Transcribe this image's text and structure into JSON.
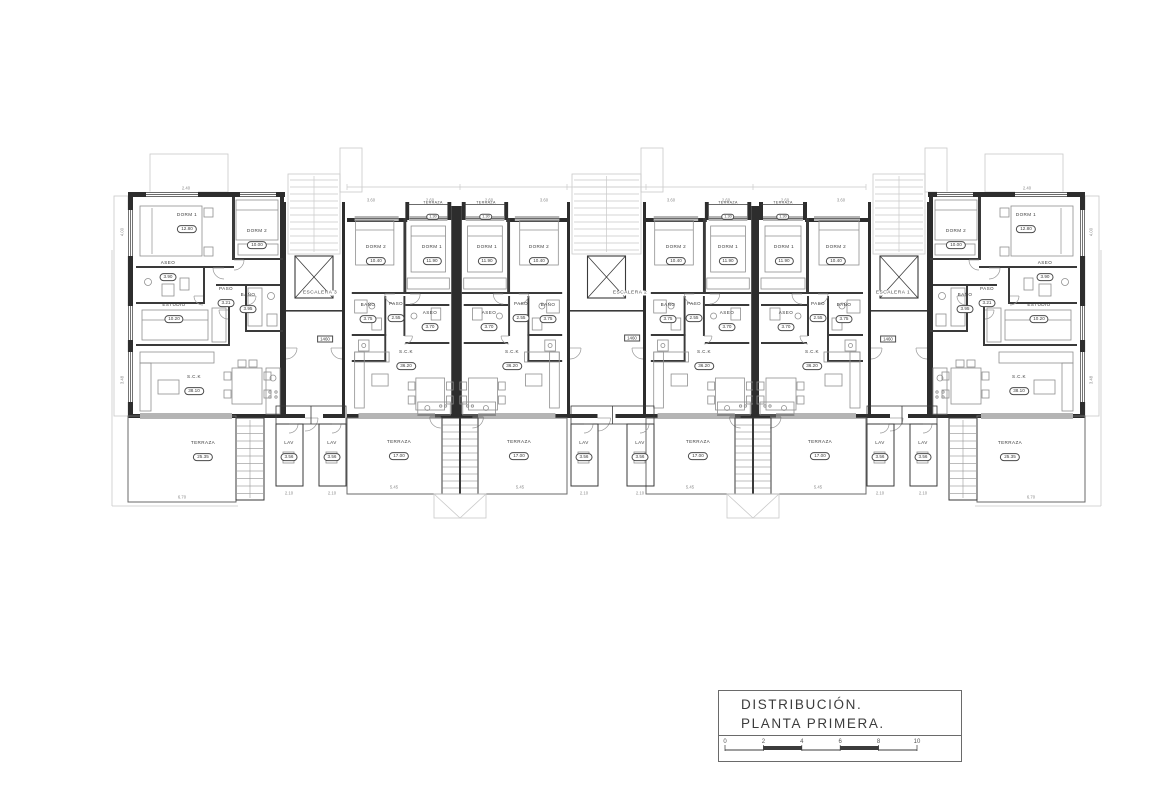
{
  "title_block": {
    "line1": "DISTRIBUCIÓN.",
    "line2": "PLANTA  PRIMERA.",
    "scale_ticks": [
      "0",
      "2",
      "4",
      "6",
      "8",
      "10"
    ]
  },
  "colors": {
    "line": "#3a3a3a",
    "wall": "#2d2d2d",
    "light": "#c9c9c9",
    "furn": "#8f8f8f",
    "dim": "#8a8a8a"
  },
  "plan": {
    "stair_labels": [
      {
        "text": "ESCALERA 3",
        "x": 320,
        "y": 293
      },
      {
        "text": "ESCALERA 2",
        "x": 630,
        "y": 293
      },
      {
        "text": "ESCALERA 1",
        "x": 893,
        "y": 293
      }
    ],
    "level_markers": [
      {
        "text": "1460",
        "x": 325,
        "y": 339
      },
      {
        "text": "1460",
        "x": 632,
        "y": 338
      },
      {
        "text": "1460",
        "x": 888,
        "y": 339
      }
    ],
    "rooms": [
      {
        "name": "DORM 1",
        "area": "12.80",
        "x": 187,
        "y": 224
      },
      {
        "name": "DORM 2",
        "area": "10.00",
        "x": 257,
        "y": 240
      },
      {
        "name": "ASEO",
        "area": "3.90",
        "x": 168,
        "y": 272
      },
      {
        "name": "PASO",
        "area": "3.21",
        "x": 226,
        "y": 298
      },
      {
        "name": "BAÑO",
        "area": "3.95",
        "x": 248,
        "y": 304
      },
      {
        "name": "ESTUDIO",
        "area": "10.20",
        "x": 174,
        "y": 314
      },
      {
        "name": "S.C.K",
        "area": "38.10",
        "x": 194,
        "y": 386
      },
      {
        "name": "TERRAZA",
        "area": "25.35",
        "x": 203,
        "y": 452
      },
      {
        "name": "LAV",
        "area": "3.56",
        "x": 289,
        "y": 452
      },
      {
        "name": "LAV",
        "area": "3.56",
        "x": 332,
        "y": 452
      },
      {
        "name": "DORM 2",
        "area": "10.40",
        "x": 376,
        "y": 256
      },
      {
        "name": "DORM 1",
        "area": "11.90",
        "x": 432,
        "y": 256
      },
      {
        "name": "TERRAZA",
        "area": "1.30",
        "x": 433,
        "y": 212,
        "s": 1
      },
      {
        "name": "BAÑO",
        "area": "3.75",
        "x": 368,
        "y": 314
      },
      {
        "name": "PASO",
        "area": "2.55",
        "x": 396,
        "y": 313
      },
      {
        "name": "ASEO",
        "area": "3.70",
        "x": 430,
        "y": 322
      },
      {
        "name": "S.C.K",
        "area": "36.20",
        "x": 406,
        "y": 361
      },
      {
        "name": "TERRAZA",
        "area": "17.00",
        "x": 399,
        "y": 451
      },
      {
        "name": "DORM 1",
        "area": "11.90",
        "x": 487,
        "y": 256
      },
      {
        "name": "DORM 2",
        "area": "10.40",
        "x": 539,
        "y": 256
      },
      {
        "name": "TERRAZA",
        "area": "1.30",
        "x": 486,
        "y": 212,
        "s": 1
      },
      {
        "name": "ASEO",
        "area": "3.70",
        "x": 489,
        "y": 322
      },
      {
        "name": "PASO",
        "area": "2.55",
        "x": 521,
        "y": 313
      },
      {
        "name": "BAÑO",
        "area": "3.75",
        "x": 548,
        "y": 314
      },
      {
        "name": "S.C.K",
        "area": "36.20",
        "x": 512,
        "y": 361
      },
      {
        "name": "TERRAZA",
        "area": "17.00",
        "x": 519,
        "y": 451
      },
      {
        "name": "LAV",
        "area": "3.56",
        "x": 584,
        "y": 452
      },
      {
        "name": "LAV",
        "area": "3.56",
        "x": 640,
        "y": 452
      },
      {
        "name": "DORM 2",
        "area": "10.40",
        "x": 676,
        "y": 256
      },
      {
        "name": "DORM 1",
        "area": "11.90",
        "x": 728,
        "y": 256
      },
      {
        "name": "TERRAZA",
        "area": "1.30",
        "x": 728,
        "y": 212,
        "s": 1
      },
      {
        "name": "BAÑO",
        "area": "3.75",
        "x": 668,
        "y": 314
      },
      {
        "name": "PASO",
        "area": "2.55",
        "x": 694,
        "y": 313
      },
      {
        "name": "ASEO",
        "area": "3.70",
        "x": 727,
        "y": 322
      },
      {
        "name": "S.C.K",
        "area": "36.20",
        "x": 704,
        "y": 361
      },
      {
        "name": "TERRAZA",
        "area": "17.00",
        "x": 698,
        "y": 451
      },
      {
        "name": "DORM 1",
        "area": "11.90",
        "x": 784,
        "y": 256
      },
      {
        "name": "DORM 2",
        "area": "10.40",
        "x": 836,
        "y": 256
      },
      {
        "name": "TERRAZA",
        "area": "1.30",
        "x": 783,
        "y": 212,
        "s": 1
      },
      {
        "name": "ASEO",
        "area": "3.70",
        "x": 786,
        "y": 322
      },
      {
        "name": "PASO",
        "area": "2.55",
        "x": 818,
        "y": 313
      },
      {
        "name": "BAÑO",
        "area": "3.75",
        "x": 844,
        "y": 314
      },
      {
        "name": "S.C.K",
        "area": "36.20",
        "x": 812,
        "y": 361
      },
      {
        "name": "TERRAZA",
        "area": "17.00",
        "x": 820,
        "y": 451
      },
      {
        "name": "LAV",
        "area": "3.56",
        "x": 880,
        "y": 452
      },
      {
        "name": "LAV",
        "area": "3.56",
        "x": 923,
        "y": 452
      },
      {
        "name": "DORM 2",
        "area": "10.00",
        "x": 956,
        "y": 240
      },
      {
        "name": "DORM 1",
        "area": "12.80",
        "x": 1026,
        "y": 224
      },
      {
        "name": "ASEO",
        "area": "3.90",
        "x": 1045,
        "y": 272
      },
      {
        "name": "BAÑO",
        "area": "3.95",
        "x": 965,
        "y": 304
      },
      {
        "name": "PASO",
        "area": "3.21",
        "x": 987,
        "y": 298
      },
      {
        "name": "ESTUDIO",
        "area": "10.20",
        "x": 1039,
        "y": 314
      },
      {
        "name": "S.C.K",
        "area": "38.10",
        "x": 1019,
        "y": 386
      },
      {
        "name": "TERRAZA",
        "area": "25.35",
        "x": 1010,
        "y": 452
      }
    ],
    "dims": [
      {
        "t": "6.70",
        "x": 182,
        "y": 497
      },
      {
        "t": "6.70",
        "x": 1031,
        "y": 497
      },
      {
        "t": "5.45",
        "x": 394,
        "y": 487
      },
      {
        "t": "5.45",
        "x": 520,
        "y": 487
      },
      {
        "t": "5.45",
        "x": 690,
        "y": 487
      },
      {
        "t": "5.45",
        "x": 818,
        "y": 487
      },
      {
        "t": "2.10",
        "x": 289,
        "y": 493
      },
      {
        "t": "2.10",
        "x": 332,
        "y": 493
      },
      {
        "t": "2.10",
        "x": 584,
        "y": 493
      },
      {
        "t": "2.10",
        "x": 640,
        "y": 493
      },
      {
        "t": "2.10",
        "x": 880,
        "y": 493
      },
      {
        "t": "2.10",
        "x": 923,
        "y": 493
      },
      {
        "t": "3.60",
        "x": 371,
        "y": 200
      },
      {
        "t": "2.60",
        "x": 430,
        "y": 200
      },
      {
        "t": "2.60",
        "x": 489,
        "y": 200
      },
      {
        "t": "3.60",
        "x": 544,
        "y": 200
      },
      {
        "t": "3.60",
        "x": 671,
        "y": 200
      },
      {
        "t": "2.60",
        "x": 726,
        "y": 200
      },
      {
        "t": "2.60",
        "x": 785,
        "y": 200
      },
      {
        "t": "3.60",
        "x": 841,
        "y": 200
      },
      {
        "t": "2.40",
        "x": 186,
        "y": 188
      },
      {
        "t": "2.40",
        "x": 1027,
        "y": 188
      },
      {
        "t": "4.00",
        "x": 122,
        "y": 232,
        "r": 1
      },
      {
        "t": "4.00",
        "x": 1091,
        "y": 232,
        "r": 1
      },
      {
        "t": "3.48",
        "x": 122,
        "y": 380,
        "r": 1
      },
      {
        "t": "3.48",
        "x": 1091,
        "y": 380,
        "r": 1
      }
    ]
  }
}
